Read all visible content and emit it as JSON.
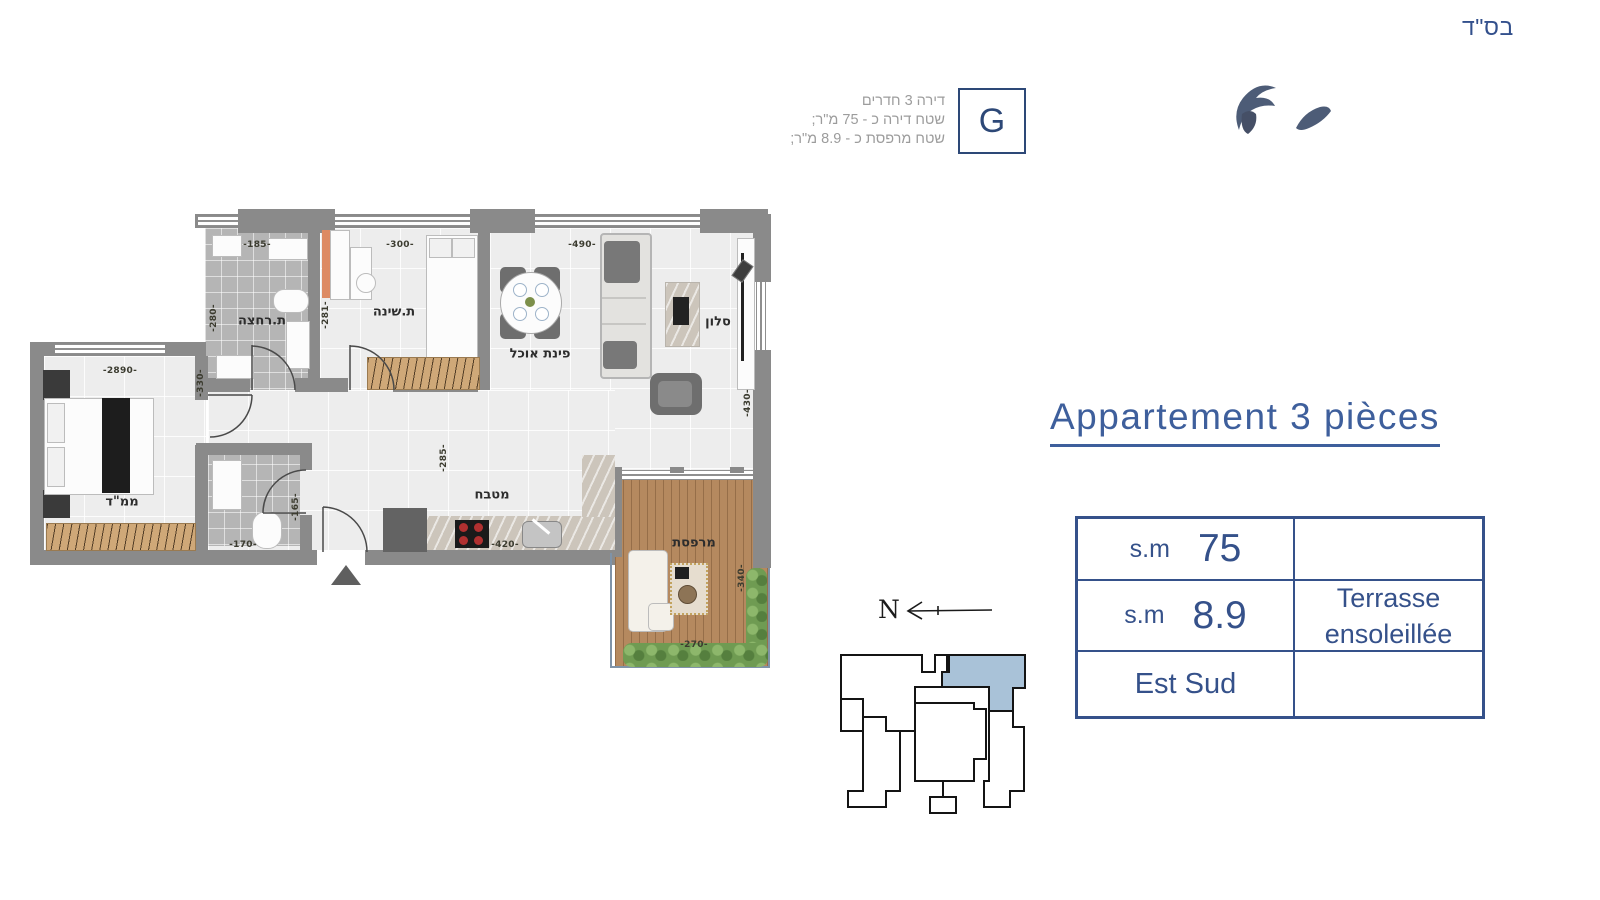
{
  "page": {
    "bsd": "בס\"ד"
  },
  "unit_info": {
    "line1": "דירה 3 חדרים",
    "line2": "שטח דירה כ - 75 מ\"ר;",
    "line3": "שטח מרפסת כ - 8.9 מ\"ר;",
    "unit_letter": "G"
  },
  "title": "Appartement 3 pièces",
  "spec_table": {
    "row1_unit": "s.m",
    "row1_value": "75",
    "row2_unit": "s.m",
    "row2_value": "8.9",
    "row2_note_line1": "Terrasse",
    "row2_note_line2": "ensoleillée",
    "row3_value": "Est Sud"
  },
  "compass": {
    "north_label": "N"
  },
  "floor_plan": {
    "room_labels": {
      "bathroom": "ת.רחצה",
      "bedroom": "ת.שינה",
      "dining": "פינת אוכל",
      "living": "סלון",
      "mamad": "ממ\"ד",
      "kitchen": "מטבח",
      "terrace": "מרפסת"
    },
    "dimensions": {
      "bathroom_w": "-185-",
      "bedroom_w": "-300-",
      "living_w": "-490-",
      "bathroom_h": "-280-",
      "bedroom_h": "-281-",
      "hall_w": "-330-",
      "mamad_w": "-2890-",
      "corridor_h": "-285-",
      "kitchen_w": "-420-",
      "wc_w": "-170-",
      "wc_h": "-165-",
      "living_h": "-430-",
      "terrace_h": "-340-",
      "terrace_w": "-270-"
    }
  },
  "colors": {
    "accent_blue": "#35518a",
    "wall_grey": "#8a8a8a",
    "highlight_unit": "#a9c2d8",
    "deck_wood": "#b5895f",
    "hedge_green": "#6f9b52"
  }
}
